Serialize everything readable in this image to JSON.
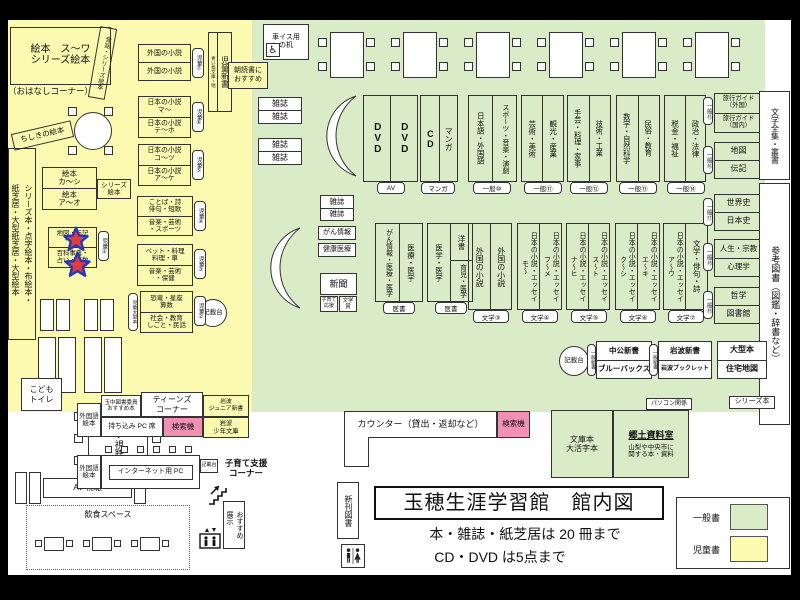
{
  "colors": {
    "children_bg": "#fbfab0",
    "general_bg": "#d9ecc7",
    "search_pink": "#f290b4"
  },
  "legend": {
    "general_label": "一般書",
    "children_label": "児童書"
  },
  "title_block": {
    "title": "玉穂生涯学習館　館内図",
    "rule1": "本・雑誌・紙芝居は 20 冊まで",
    "rule2": "CD・DVD は5点まで"
  },
  "children": {
    "ohanashi_shelf": "絵本　ス～ワ\nシリーズ絵本",
    "ohanashi_caption": "（おはなしコーナー）",
    "mukashibanashi": "昔話・シリーズ絵本",
    "chishiki": "ちしきの絵本",
    "left_shelf": "シリーズ本・点字絵本・布絵本・\n紙芝居・大型紙芝居・大型絵本",
    "ehon": {
      "rows": [
        "絵本\nカ～シ",
        "絵本\nア～オ"
      ],
      "side": "シリーズ\n絵本"
    },
    "star_shelf": {
      "rows": [
        "地図・伝記\n・歴史",
        "百科事典・\n占い・算数"
      ],
      "tab": "児童①"
    },
    "shelves": [
      {
        "rows": [
          "外国の小説",
          "外国の小説"
        ],
        "tab": "児童⑦"
      },
      {
        "rows": [
          "日本の小説\nマ～",
          "日本の小説\nテ～ホ"
        ],
        "tab": "児童⑥"
      },
      {
        "rows": [
          "日本の小説\nコ～ツ",
          "日本の小説\nア～ケ"
        ],
        "tab": "児童⑤"
      },
      {
        "rows": [
          "ことば・詩\n俳句・短歌",
          "音楽・芸術\n・スポーツ"
        ],
        "tab": "児童④"
      },
      {
        "rows": [
          "ペット・料理\n料理・車",
          "音楽・芸術\n・保健"
        ],
        "tab": "児童③"
      },
      {
        "rows": [
          "恐竜・星座\n算数",
          "社会・教育\nしごと・民話"
        ],
        "tab": "児童②",
        "side": "児童大型本"
      }
    ],
    "kisaidai": "記載台",
    "jido_shinsho": "児童新書",
    "aoitori": "青い鳥文庫・他",
    "asadoku": "朝読書に\nおすすめ",
    "kodomo_toilet": "こども\nトイレ"
  },
  "general": {
    "wheelchair_desk": "車イス用\nの机",
    "magazine": "雑誌",
    "gan_joho": "がん情報",
    "kenko_iryo": "健康医療",
    "shinbun": "新聞",
    "kosodate_ouen": "子育て\n応援",
    "bungaku_sho": "文学賞",
    "av_pair": {
      "cells": [
        "DVD",
        "DVD"
      ],
      "tab": "AV"
    },
    "cd_pair": {
      "cells": [
        "CD",
        "マンガ"
      ],
      "tab": "マンガ"
    },
    "top_pairs": [
      {
        "cells": [
          "日本語・外国語",
          "スポーツ・音楽・演劇"
        ],
        "tab": "一般⑩"
      },
      {
        "cells": [
          "芸術・美術",
          "観光・産業"
        ],
        "tab": "一般⑪"
      },
      {
        "cells": [
          "手芸・料理・家事",
          "技術・工業"
        ],
        "tab": "一般⑫"
      },
      {
        "cells": [
          "数学・自然科学",
          "民俗・教育"
        ],
        "tab": "一般⑬"
      },
      {
        "cells": [
          "税金・福祉",
          "政治・法律"
        ],
        "tab": "一般⑭"
      }
    ],
    "right_stack": [
      {
        "rows": [
          "旅行ガイド\n（外国）",
          "旅行ガイド\n（国内）"
        ],
        "tab": "一般⑮"
      },
      {
        "rows": [
          "地図",
          "伝記"
        ],
        "tab": "一般⑯"
      },
      {
        "rows": [
          "世界史",
          "日本史"
        ],
        "tab": "一般⑰"
      },
      {
        "rows": [
          "人生・宗教",
          "心理学"
        ],
        "tab": "一般⑱"
      },
      {
        "rows": [
          "哲学",
          "図書館"
        ],
        "tab": "一般⑲"
      }
    ],
    "strip_literature": "文学全集・叢書",
    "strip_reference": "参考図書（図鑑・辞書など）",
    "medical_pairs": [
      {
        "cells": [
          "がん情報・医療・医学",
          "医療・医学"
        ],
        "tab": "医書"
      },
      {
        "left": "医学・医学",
        "right_top": "洋書",
        "right_bottom": "育児・医学",
        "tab": "医書"
      }
    ],
    "literature_pairs": [
      {
        "cells": [
          "外国の小説",
          "外国の小説"
        ],
        "tab": "文学③"
      },
      {
        "cells": [
          "日本の小説・エッセイ\nモ～",
          "日本の小説・エッセイ\nフ～メ"
        ],
        "tab": "文学④"
      },
      {
        "cells": [
          "日本の小説・エッセイ\nナ～ヒ",
          "日本の小説・エッセイ\nス～ト"
        ],
        "tab": "文学⑤"
      },
      {
        "cells": [
          "日本の小説・エッセイ\nク～シ",
          "日本の小説・エッセイ\nエ～キ"
        ],
        "tab": "文学⑥"
      },
      {
        "cells": [
          "日本の小説・エッセイ\nア～ウ",
          "文学・俳句・詩"
        ],
        "tab": "文学⑦"
      }
    ],
    "kisaidai": "記載台",
    "shinsho_tab": "一般新書",
    "chuko": {
      "rows": [
        "中公新書",
        "ブルーバックス"
      ]
    },
    "iwanami": {
      "rows": [
        "岩波新書",
        "岩波ブックレット"
      ]
    },
    "ogata": {
      "rows": [
        "大型本",
        "住宅地図"
      ]
    },
    "pc_kankei": "パソコン関係",
    "series_bon": "シリーズ本"
  },
  "bottom": {
    "counter": "カウンター（貸出・返却など）",
    "kensakuki": "検索機",
    "bunko": "文庫本\n大活字本",
    "kyodo_title": "郷土資料室",
    "kyodo_desc": "山梨や中央市に\n関する本・資料",
    "shinkan": "新刊図書",
    "av_table": "AV視聴",
    "av_box": "AV 視聴",
    "gaikokugo_ehon": "外国語\n絵本",
    "tamachu": "玉中図書委員\nおすすめ本",
    "teens": "ティーンズ\nコーナー",
    "iwanami_junior": "岩波\nジュニア新書",
    "mochikomi": "持ち込み PC 席",
    "iwanami_shonen": "岩波\n少年文庫",
    "internet_pc": "インターネット用 PC",
    "kisaidai": "記載台",
    "kosodate_shien": "子育て支援\nコーナー",
    "osusume": "おすすめ\n展示",
    "inshoku": "飲食スペース"
  }
}
